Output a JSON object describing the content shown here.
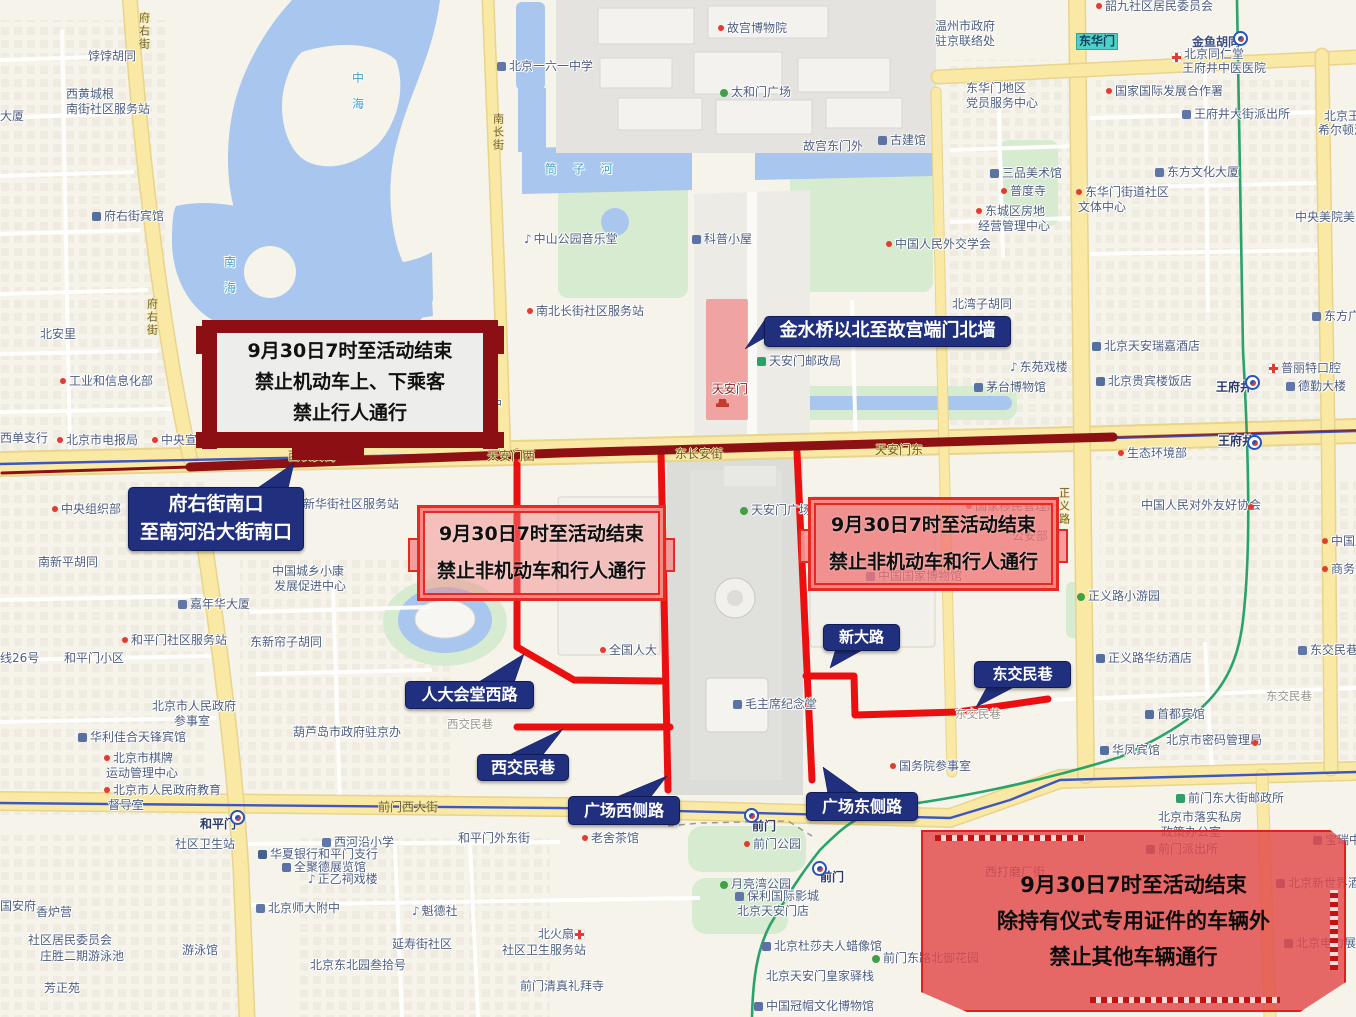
{
  "colors": {
    "restricted_road": "#ec0f0f",
    "closed_changan_segment": "#8d1013",
    "callout_bg": "#20307f",
    "notice_frame_red": "#e62a22",
    "water": "#a9c7ee",
    "main_road_yellow": "#f9e9a4"
  },
  "banner": {
    "line1": "9月30日7时至活动结束",
    "line2": "禁止机动车上、下乘客",
    "line3": "禁止行人通行"
  },
  "box_west": {
    "line1": "9月30日7时至活动结束",
    "line2": "禁止非机动车和行人通行"
  },
  "box_east": {
    "line1": "9月30日7时至活动结束",
    "line2": "禁止非机动车和行人通行"
  },
  "box_south": {
    "line1": "9月30日7时至活动结束",
    "line2": "除持有仪式专用证件的车辆外",
    "line3": "禁止其他车辆通行"
  },
  "callouts": [
    {
      "name": "fuyoujie-section",
      "x": 128,
      "y": 487,
      "w": 174,
      "h": 62,
      "fs": 19,
      "lines": [
        "府右街南口",
        "至南河沿大街南口"
      ],
      "tail": [
        294,
        463,
        256,
        489,
        288,
        489
      ]
    },
    {
      "name": "jinshuiqiao-section",
      "x": 764,
      "y": 316,
      "w": 245,
      "h": 29,
      "fs": 18,
      "lines": [
        "金水桥以北至故宫端门北墙"
      ],
      "tail": [
        745,
        349,
        766,
        318,
        766,
        337
      ]
    },
    {
      "name": "rendahuitang-xilu",
      "x": 405,
      "y": 681,
      "w": 127,
      "h": 26,
      "fs": 16,
      "lines": [
        "人大会堂西路"
      ],
      "tail": [
        524,
        654,
        477,
        683,
        514,
        683
      ]
    },
    {
      "name": "xijiaominxiang",
      "x": 477,
      "y": 754,
      "w": 90,
      "h": 25,
      "fs": 16,
      "lines": [
        "西交民巷"
      ],
      "tail": [
        563,
        729,
        507,
        756,
        542,
        756
      ]
    },
    {
      "name": "guangchang-xicelu",
      "x": 568,
      "y": 796,
      "w": 110,
      "h": 27,
      "fs": 16,
      "lines": [
        "广场西侧路"
      ],
      "tail": [
        667,
        776,
        614,
        798,
        650,
        798
      ]
    },
    {
      "name": "guangchang-dongcelu",
      "x": 806,
      "y": 792,
      "w": 110,
      "h": 27,
      "fs": 16,
      "lines": [
        "广场东侧路"
      ],
      "tail": [
        823,
        767,
        828,
        794,
        861,
        794
      ]
    },
    {
      "name": "xindalu",
      "x": 823,
      "y": 624,
      "w": 75,
      "h": 25,
      "fs": 15,
      "lines": [
        "新大路"
      ],
      "tail": [
        830,
        668,
        836,
        648,
        866,
        648
      ]
    },
    {
      "name": "dongjiaominxiang",
      "x": 974,
      "y": 661,
      "w": 95,
      "h": 25,
      "fs": 15,
      "lines": [
        "东交民巷"
      ],
      "tail": [
        976,
        707,
        988,
        685,
        1018,
        685
      ]
    }
  ],
  "map": {
    "highlight_station": {
      "t": "东华门",
      "x": 1076,
      "y": 33
    },
    "stations": [
      [
        230,
        810
      ],
      [
        744,
        808
      ],
      [
        812,
        861
      ],
      [
        1245,
        375
      ],
      [
        1247,
        435
      ],
      [
        1233,
        31
      ]
    ],
    "labels": [
      {
        "t": "饽饽胡同",
        "x": 88,
        "y": 50
      },
      {
        "t": "西黄城根",
        "x": 66,
        "y": 88
      },
      {
        "t": "南街社区服务站",
        "x": 66,
        "y": 103
      },
      {
        "t": "大厦",
        "x": 0,
        "y": 110
      },
      {
        "t": "府右街宾馆",
        "x": 92,
        "y": 210,
        "i": "hotel"
      },
      {
        "t": "北安里",
        "x": 40,
        "y": 328
      },
      {
        "t": "工业和信息化部",
        "x": 60,
        "y": 375,
        "i": "dot"
      },
      {
        "t": "西单支行",
        "x": 0,
        "y": 432
      },
      {
        "t": "北京市电报局",
        "x": 57,
        "y": 434,
        "i": "dot"
      },
      {
        "t": "中央宣传部",
        "x": 152,
        "y": 434,
        "i": "dot"
      },
      {
        "t": "中央组织部",
        "x": 52,
        "y": 503,
        "i": "dot"
      },
      {
        "t": "新华街社区服务站",
        "x": 303,
        "y": 498
      },
      {
        "t": "南新平胡同",
        "x": 38,
        "y": 556
      },
      {
        "t": "中国城乡小康",
        "x": 272,
        "y": 565
      },
      {
        "t": "发展促进中心",
        "x": 274,
        "y": 580
      },
      {
        "t": "嘉年华大厦",
        "x": 178,
        "y": 598,
        "i": "sq"
      },
      {
        "t": "和平门社区服务站",
        "x": 122,
        "y": 634,
        "i": "dot"
      },
      {
        "t": "东新帘子胡同",
        "x": 250,
        "y": 636
      },
      {
        "t": "和平门小区",
        "x": 64,
        "y": 652
      },
      {
        "t": "线26号",
        "x": 0,
        "y": 652
      },
      {
        "t": "北京市人民政府",
        "x": 152,
        "y": 700
      },
      {
        "t": "参事室",
        "x": 174,
        "y": 715
      },
      {
        "t": "华利佳合天锋宾馆",
        "x": 78,
        "y": 731,
        "i": "hotel"
      },
      {
        "t": "葫芦岛市政府驻京办",
        "x": 293,
        "y": 726
      },
      {
        "t": "北京市棋牌",
        "x": 104,
        "y": 752,
        "i": "dot"
      },
      {
        "t": "运动管理中心",
        "x": 106,
        "y": 767
      },
      {
        "t": "北京市人民政府教育",
        "x": 104,
        "y": 784,
        "i": "dot"
      },
      {
        "t": "督导室",
        "x": 108,
        "y": 799
      },
      {
        "t": "游泳馆",
        "x": 182,
        "y": 944
      },
      {
        "t": "国安府",
        "x": 0,
        "y": 900
      },
      {
        "t": "香炉营",
        "x": 36,
        "y": 906
      },
      {
        "t": "社区居民委员会",
        "x": 28,
        "y": 934
      },
      {
        "t": "庄胜二期游泳池",
        "x": 40,
        "y": 950
      },
      {
        "t": "芳正苑",
        "x": 44,
        "y": 982
      },
      {
        "t": "和平门",
        "x": 200,
        "y": 818,
        "c": "st"
      },
      {
        "t": "社区卫生站",
        "x": 175,
        "y": 838
      },
      {
        "t": "华夏银行和平门支行",
        "x": 258,
        "y": 848,
        "i": "bank"
      },
      {
        "t": "西河沿小学",
        "x": 322,
        "y": 836,
        "i": "sq"
      },
      {
        "t": "全聚德展览馆",
        "x": 282,
        "y": 861,
        "i": "mus"
      },
      {
        "t": "正乙祠戏楼",
        "x": 308,
        "y": 873,
        "i": "music"
      },
      {
        "t": "北京师大附中",
        "x": 256,
        "y": 902,
        "i": "sq"
      },
      {
        "t": "和平门外东街",
        "x": 458,
        "y": 832
      },
      {
        "t": "魁德社",
        "x": 412,
        "y": 905,
        "i": "music"
      },
      {
        "t": "延寿街社区",
        "x": 392,
        "y": 938
      },
      {
        "t": "北京东北园叁拾号",
        "x": 310,
        "y": 959
      },
      {
        "t": "北火扇",
        "x": 538,
        "y": 928
      },
      {
        "t": "",
        "x": 574,
        "y": 929,
        "i": "cr"
      },
      {
        "t": "社区卫生服务站",
        "x": 502,
        "y": 944
      },
      {
        "t": "前门清真礼拜寺",
        "x": 520,
        "y": 980
      },
      {
        "t": "老舍茶馆",
        "x": 582,
        "y": 832,
        "i": "dot"
      },
      {
        "t": "前门公园",
        "x": 744,
        "y": 838,
        "i": "dot"
      },
      {
        "t": "月亮湾公园",
        "x": 720,
        "y": 878,
        "i": "tree"
      },
      {
        "t": "保利国际影城",
        "x": 735,
        "y": 890,
        "i": "sq"
      },
      {
        "t": "北京天安门店",
        "x": 737,
        "y": 905
      },
      {
        "t": "北京杜莎夫人蜡像馆",
        "x": 762,
        "y": 940,
        "i": "mus"
      },
      {
        "t": "前门东路北御花园",
        "x": 872,
        "y": 952,
        "i": "tree"
      },
      {
        "t": "北京天安门皇家驿栈",
        "x": 766,
        "y": 970
      },
      {
        "t": "中国冠帽文化博物馆",
        "x": 754,
        "y": 1000,
        "i": "mus"
      },
      {
        "t": "前门",
        "x": 752,
        "y": 820,
        "c": "st"
      },
      {
        "t": "前门",
        "x": 820,
        "y": 871,
        "c": "st"
      },
      {
        "t": "全国人大",
        "x": 600,
        "y": 644,
        "i": "dot"
      },
      {
        "t": "西交民巷",
        "x": 447,
        "y": 718,
        "c": "g"
      },
      {
        "t": "天安门广场",
        "x": 740,
        "y": 504,
        "i": "tree"
      },
      {
        "t": "毛主席纪念堂",
        "x": 733,
        "y": 698,
        "i": "mus"
      },
      {
        "t": "东长安街",
        "x": 675,
        "y": 448,
        "c": "r"
      },
      {
        "t": "西长安街",
        "x": 288,
        "y": 450,
        "c": "r"
      },
      {
        "t": "天安门东",
        "x": 875,
        "y": 444,
        "c": "r"
      },
      {
        "t": "天安门西",
        "x": 487,
        "y": 450,
        "c": "r"
      },
      {
        "t": "前门西大街",
        "x": 378,
        "y": 801,
        "c": "r"
      },
      {
        "t": "故宫博物院",
        "x": 718,
        "y": 22,
        "i": "dot"
      },
      {
        "t": "太和门广场",
        "x": 720,
        "y": 86,
        "i": "tree"
      },
      {
        "t": "北京一六一中学",
        "x": 497,
        "y": 60,
        "i": "sq"
      },
      {
        "t": "北京一六一中",
        "x": 430,
        "y": 398
      },
      {
        "t": "学高中部",
        "x": 432,
        "y": 413
      },
      {
        "t": "故宫东门外",
        "x": 803,
        "y": 140
      },
      {
        "t": "古建馆",
        "x": 878,
        "y": 134,
        "i": "mus"
      },
      {
        "t": "筒 子 河",
        "x": 545,
        "y": 163,
        "c": "w"
      },
      {
        "t": "中",
        "x": 352,
        "y": 72,
        "c": "w"
      },
      {
        "t": "海",
        "x": 352,
        "y": 98,
        "c": "w"
      },
      {
        "t": "南",
        "x": 224,
        "y": 256,
        "c": "w"
      },
      {
        "t": "海",
        "x": 224,
        "y": 282,
        "c": "w"
      },
      {
        "t": "北湾子胡同",
        "x": 952,
        "y": 298
      },
      {
        "t": "天安门邮政局",
        "x": 757,
        "y": 355,
        "i": "post"
      },
      {
        "t": "天安门",
        "x": 712,
        "y": 383,
        "c": "tam"
      },
      {
        "t": "",
        "x": 716,
        "y": 396,
        "i": "gate"
      },
      {
        "t": "东苑戏楼",
        "x": 1010,
        "y": 361,
        "i": "music"
      },
      {
        "t": "茅台博物馆",
        "x": 974,
        "y": 381,
        "i": "mus"
      },
      {
        "t": "中山公园音乐堂",
        "x": 524,
        "y": 233,
        "i": "music"
      },
      {
        "t": "科普小屋",
        "x": 692,
        "y": 233,
        "i": "mus"
      },
      {
        "t": "中国人民外交学会",
        "x": 886,
        "y": 238,
        "i": "dot"
      },
      {
        "t": "南北长街社区服务站",
        "x": 527,
        "y": 305,
        "i": "dot"
      },
      {
        "t": "北京天安瑞嘉酒店",
        "x": 1092,
        "y": 340,
        "i": "hotel"
      },
      {
        "t": "北京贵宾楼饭店",
        "x": 1096,
        "y": 375,
        "i": "hotel"
      },
      {
        "t": "王府井",
        "x": 1216,
        "y": 381,
        "c": "st"
      },
      {
        "t": "王府井",
        "x": 1218,
        "y": 435,
        "c": "st"
      },
      {
        "t": "生态环境部",
        "x": 1118,
        "y": 447,
        "i": "dot"
      },
      {
        "t": "金鱼胡同",
        "x": 1192,
        "y": 36,
        "c": "b"
      },
      {
        "t": "北京同仁堂",
        "x": 1184,
        "y": 48
      },
      {
        "t": "",
        "x": 1171,
        "y": 52,
        "i": "cr"
      },
      {
        "t": "王府井中医医院",
        "x": 1182,
        "y": 62
      },
      {
        "t": "国家国际发展合作署",
        "x": 1106,
        "y": 85,
        "i": "dot"
      },
      {
        "t": "王府井大街派出所",
        "x": 1182,
        "y": 108,
        "i": "sq"
      },
      {
        "t": "韶九社区居民委员会",
        "x": 1096,
        "y": 0,
        "i": "dot"
      },
      {
        "t": "温州市政府",
        "x": 935,
        "y": 20
      },
      {
        "t": "驻京联络处",
        "x": 935,
        "y": 35
      },
      {
        "t": "东华门地区",
        "x": 966,
        "y": 82
      },
      {
        "t": "党员服务中心",
        "x": 966,
        "y": 97
      },
      {
        "t": "三品美术馆",
        "x": 990,
        "y": 167,
        "i": "mus"
      },
      {
        "t": "普度寺",
        "x": 1001,
        "y": 185,
        "i": "dot"
      },
      {
        "t": "东城区房地",
        "x": 976,
        "y": 205,
        "i": "dot"
      },
      {
        "t": "经营管理中心",
        "x": 978,
        "y": 220
      },
      {
        "t": "东华门街道社区",
        "x": 1076,
        "y": 186,
        "i": "dot"
      },
      {
        "t": "文体中心",
        "x": 1078,
        "y": 201
      },
      {
        "t": "东方文化大厦",
        "x": 1155,
        "y": 166,
        "i": "sq"
      },
      {
        "t": "北京王府",
        "x": 1324,
        "y": 110
      },
      {
        "t": "希尔顿酒店",
        "x": 1318,
        "y": 124
      },
      {
        "t": "中央美院美术馆",
        "x": 1295,
        "y": 211
      },
      {
        "t": "东方广场",
        "x": 1312,
        "y": 310,
        "i": "sq"
      },
      {
        "t": "普丽特口腔",
        "x": 1281,
        "y": 362
      },
      {
        "t": "",
        "x": 1268,
        "y": 363,
        "i": "cr"
      },
      {
        "t": "德勤大楼",
        "x": 1286,
        "y": 380,
        "i": "sq"
      },
      {
        "t": "中国人民对外友好协会",
        "x": 1141,
        "y": 499
      },
      {
        "t": "",
        "x": 1248,
        "y": 501,
        "i": "dot"
      },
      {
        "t": "正义路小游园",
        "x": 1077,
        "y": 590,
        "i": "tree"
      },
      {
        "t": "正义路华纺酒店",
        "x": 1096,
        "y": 652,
        "i": "hotel"
      },
      {
        "t": "东交民巷小学",
        "x": 1298,
        "y": 644,
        "i": "sq"
      },
      {
        "t": "东交民巷",
        "x": 1266,
        "y": 690,
        "c": "g"
      },
      {
        "t": "东交民巷",
        "x": 955,
        "y": 708,
        "c": "g"
      },
      {
        "t": "中国质检",
        "x": 1322,
        "y": 535,
        "i": "dot"
      },
      {
        "t": "商务部",
        "x": 1322,
        "y": 563,
        "i": "dot"
      },
      {
        "t": "首都宾馆",
        "x": 1145,
        "y": 708,
        "i": "hotel"
      },
      {
        "t": "北京市密码管理局",
        "x": 1166,
        "y": 734
      },
      {
        "t": "",
        "x": 1252,
        "y": 737,
        "i": "dot"
      },
      {
        "t": "华凤宾馆",
        "x": 1100,
        "y": 744,
        "i": "hotel"
      },
      {
        "t": "国务院参事室",
        "x": 890,
        "y": 760,
        "i": "dot"
      },
      {
        "t": "国家移民管理局",
        "x": 966,
        "y": 500,
        "i": "dot"
      },
      {
        "t": "中国国家博物馆",
        "x": 866,
        "y": 570,
        "i": "mus"
      },
      {
        "t": "公安部",
        "x": 1012,
        "y": 530
      },
      {
        "t": "前门东大街邮政所",
        "x": 1176,
        "y": 792,
        "i": "post"
      },
      {
        "t": "北京市落实私房",
        "x": 1158,
        "y": 811
      },
      {
        "t": "政策办公室",
        "x": 1161,
        "y": 826
      },
      {
        "t": "前门派出所",
        "x": 1146,
        "y": 843,
        "i": "sq"
      },
      {
        "t": "宝瑞中心",
        "x": 1313,
        "y": 834,
        "i": "sq"
      },
      {
        "t": "北京新世界酒店",
        "x": 1276,
        "y": 877,
        "i": "hotel"
      },
      {
        "t": "北京电力展示厅",
        "x": 1284,
        "y": 937,
        "i": "mus"
      },
      {
        "t": "西打磨厂街",
        "x": 985,
        "y": 866
      },
      {
        "t": "正义路",
        "x": 1058,
        "y": 487,
        "c": "vr"
      },
      {
        "t": "府右街",
        "x": 146,
        "y": 298,
        "c": "vr"
      },
      {
        "t": "府右街",
        "x": 138,
        "y": 12,
        "c": "vr"
      },
      {
        "t": "南长街",
        "x": 492,
        "y": 113,
        "c": "vr"
      }
    ]
  }
}
